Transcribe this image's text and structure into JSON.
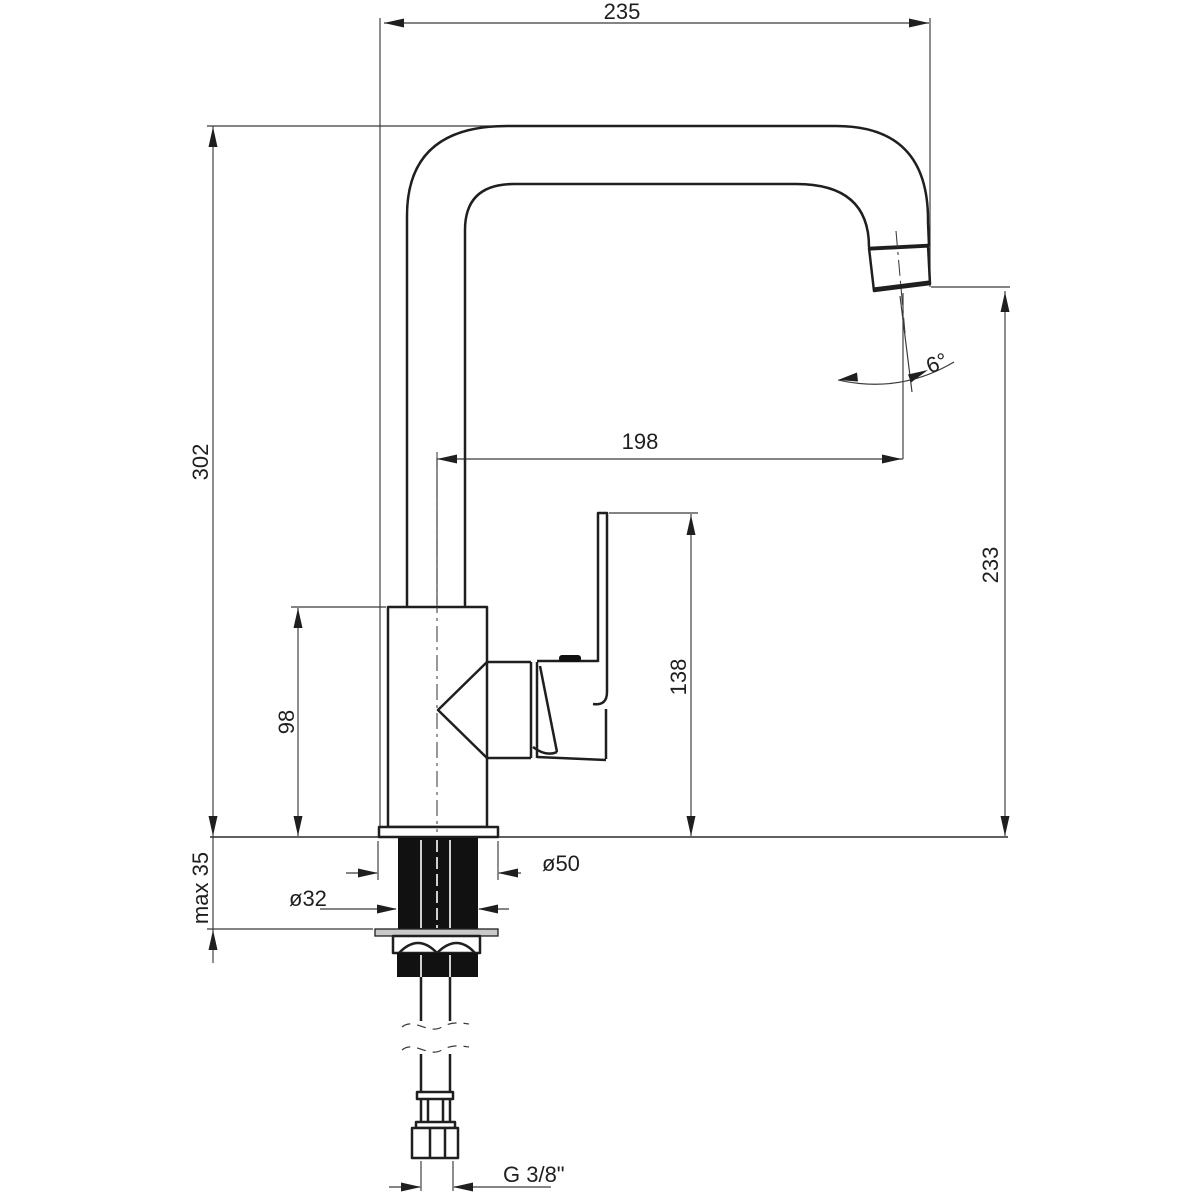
{
  "drawing": {
    "title": "Kitchen mixer tap – dimensioned side elevation",
    "units": "mm",
    "dimensions": {
      "overall_depth": "235",
      "overall_height": "302",
      "spout_reach": "198",
      "spout_outlet_height": "233",
      "handle_height": "138",
      "body_height": "98",
      "max_mounting_thickness": "max 35",
      "base_diameter": "ø50",
      "shank_diameter": "ø32",
      "outlet_angle": "6°",
      "supply_thread": "G 3/8\""
    },
    "colors": {
      "outline": "#1f1f1f",
      "dimension_line": "#3a3a3a",
      "background": "#ffffff"
    }
  }
}
